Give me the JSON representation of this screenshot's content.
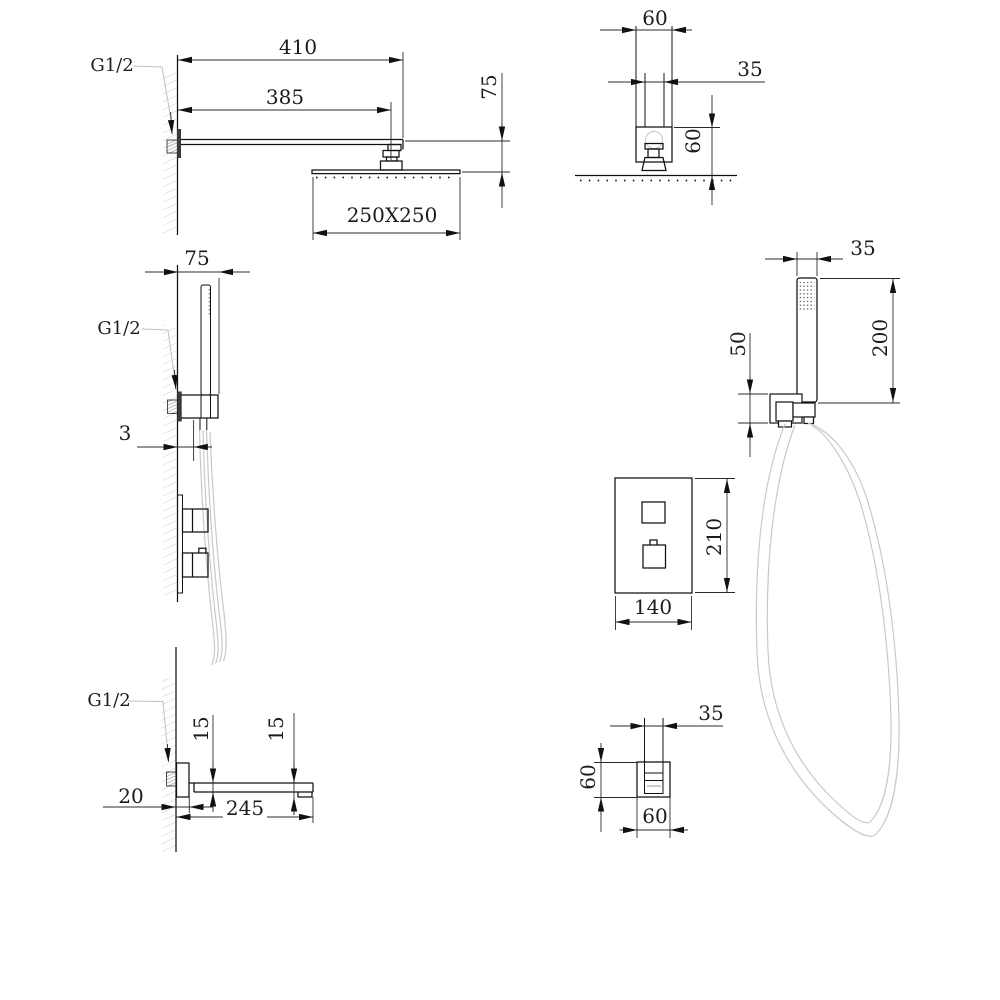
{
  "meta": {
    "type": "technical-dimension-drawing",
    "subject": "concealed shower system (rain head, hand shower, thermostatic valve, bath spout)"
  },
  "colors": {
    "line": "#1a1a1a",
    "light_line": "#c9c9c9",
    "text": "#1c1c1c",
    "background": "#ffffff"
  },
  "views": {
    "rain_shower_side": {
      "thread": "G1/2",
      "overall_reach": "410",
      "arm_length": "385",
      "head_drop": "75",
      "head_size": "250X250"
    },
    "rain_shower_front": {
      "flange_width": "60",
      "arm_width": "35",
      "flange_drop": "60"
    },
    "hand_shower_side": {
      "wall_offset": "75",
      "thread": "G1/2",
      "plate_thickness": "3"
    },
    "hand_shower_front": {
      "wand_width": "35",
      "wand_length": "200",
      "bracket_height": "50"
    },
    "valve_plate_front": {
      "plate_height": "210",
      "plate_width": "140"
    },
    "spout_side": {
      "thread": "G1/2",
      "body_height": "15",
      "tip_height": "15",
      "wall_plate_depth": "20",
      "spout_length": "245"
    },
    "spout_front": {
      "spout_width": "35",
      "body_height": "60",
      "body_width": "60"
    }
  }
}
